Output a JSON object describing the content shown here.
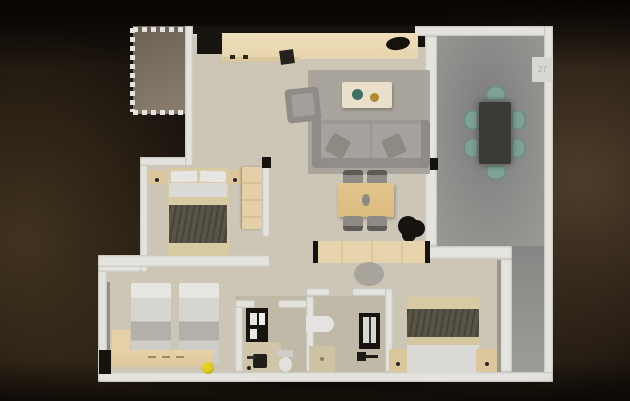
{
  "scene": {
    "type": "3d-floor-plan-render",
    "description": "Top-down 3D render of a three-bedroom apartment with terrace on a dark brown backdrop",
    "visible_text_count": 1
  },
  "terrace": {
    "unit_label": "27"
  },
  "palette": {
    "bg_base": "#1a130d",
    "bg_glow_right": "#4e3d2a",
    "bg_glow_left": "#41331f",
    "bg_glow_bottom": "#332818",
    "wall": "#e4e3de",
    "floor": "#cdc5b6",
    "balcony": "#7d7264",
    "terrace_mid": "#7b7b79",
    "terrace_light": "#9a9a97",
    "wood_light": "#e8d5ae",
    "wood_mid": "#dcbb80",
    "wood_ns": "#dcc69d",
    "counter_black": "#17130e",
    "sofa": "#9c9994",
    "sofa_dark": "#8f8c87",
    "rug": "#a9a59c",
    "gray_chair": "#8e8b86",
    "table_dark": "#3a3a37",
    "teal": "#7ea295",
    "blanket": "#585448",
    "bed_band": "#d8caa2",
    "linen": "#dcdad6",
    "linen_bright": "#e8e6e2",
    "twin_fold": "#b3b0aa",
    "black": "#16120d",
    "ball": "#d8c41f",
    "fixture": "#d8d7d3",
    "stool": "#a5a19a",
    "plate_teal": "#3f7066",
    "gold": "#b08a33"
  },
  "rooms": [
    {
      "name": "balcony",
      "features": [
        "dashed boundary markers",
        "dark taupe floor"
      ]
    },
    {
      "name": "kitchen",
      "furniture": [
        "counter with dark appliance block",
        "sink basin"
      ]
    },
    {
      "name": "living-room",
      "furniture": [
        "sofa with 2 pillows",
        "armchair",
        "coffee table with teal plate and gold bowl",
        "gray rug",
        "wood dining table",
        "4 gray chairs",
        "dark plant"
      ]
    },
    {
      "name": "terrace",
      "furniture": [
        "dark dining table",
        "6 teal chairs",
        "white wall unit"
      ]
    },
    {
      "name": "bedroom-master",
      "furniture": [
        "double bed with dark blanket",
        "2 nightstands",
        "wardrobe"
      ]
    },
    {
      "name": "bedroom-twin",
      "furniture": [
        "2 twin beds",
        "wood bench",
        "yellow ball",
        "dark cabinet"
      ]
    },
    {
      "name": "bathroom-1",
      "furniture": [
        "dark shower unit",
        "vanity with sink",
        "toilet"
      ]
    },
    {
      "name": "bathroom-2",
      "furniture": [
        "white basin",
        "dark shower unit",
        "shower tray",
        "faucet"
      ]
    },
    {
      "name": "bedroom-3",
      "furniture": [
        "double bed with dark blanket",
        "2 nightstands"
      ]
    },
    {
      "name": "hallway",
      "furniture": [
        "built-in wood closet",
        "gray stool"
      ]
    }
  ]
}
